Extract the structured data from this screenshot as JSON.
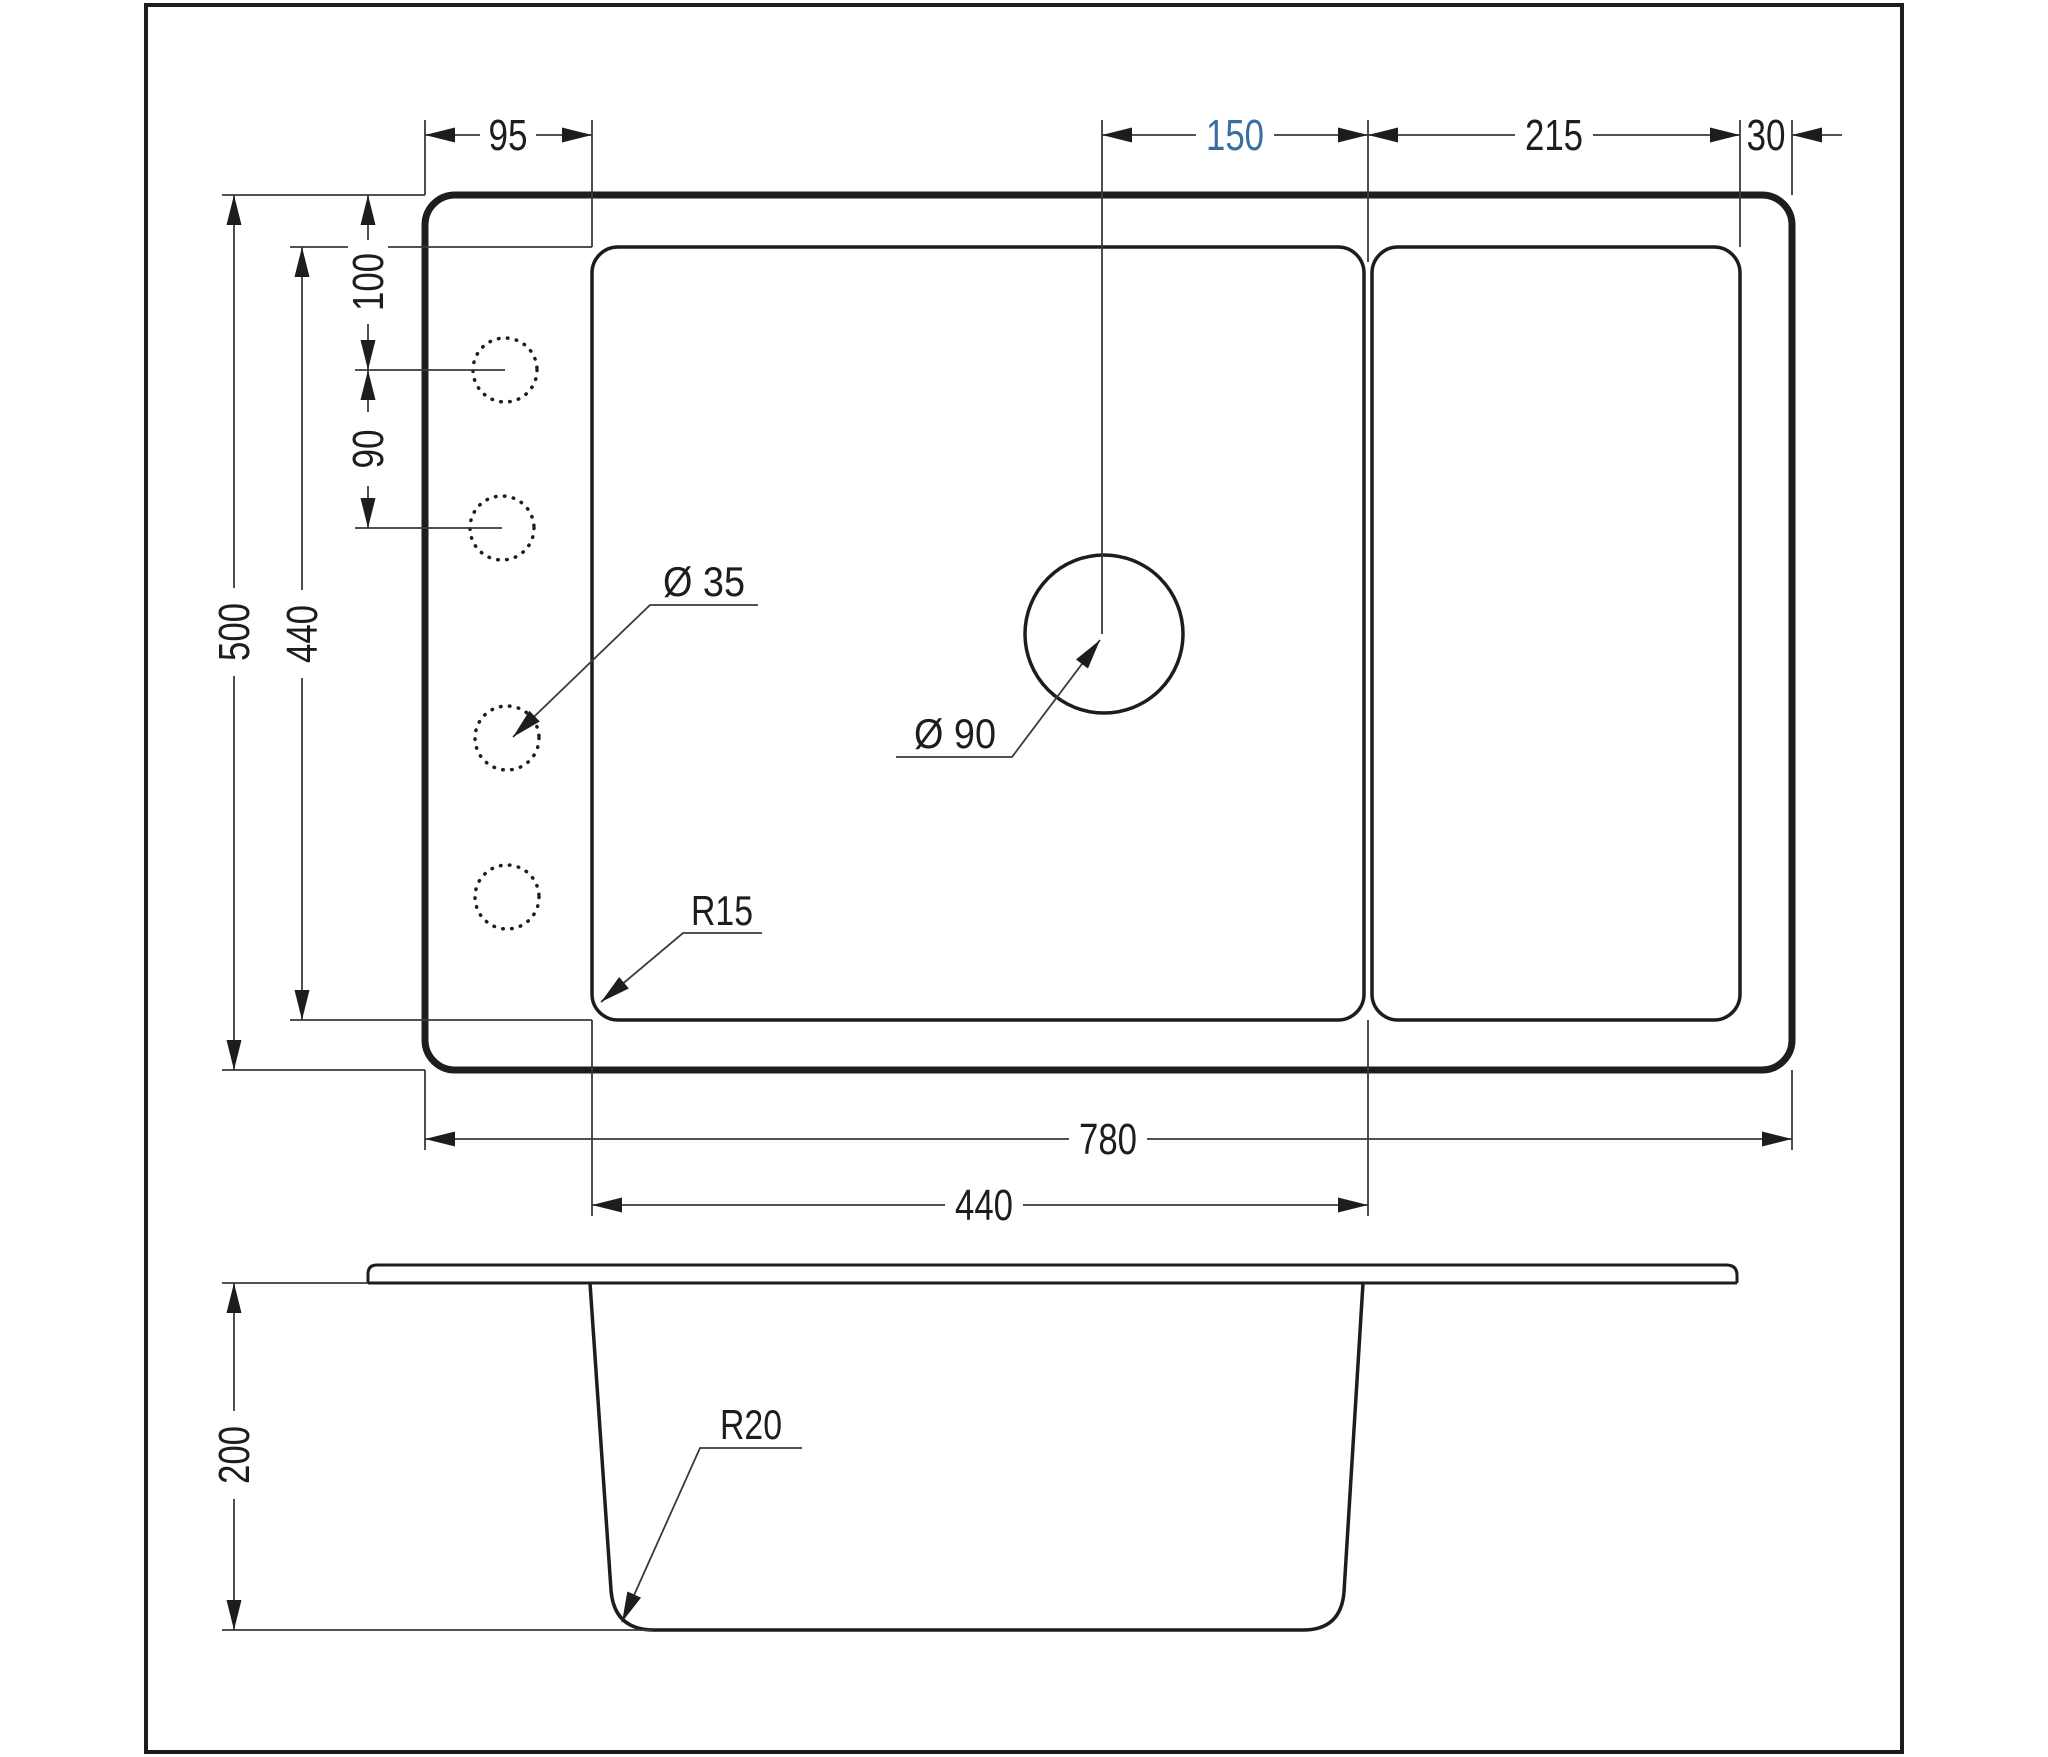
{
  "drawing": {
    "line_color": "#1d1d1b",
    "accent_color": "#376fa3",
    "background": "#ffffff"
  },
  "top_view": {
    "dims": {
      "left_offset": "95",
      "drain_offset": "150",
      "drain_to_edge": "215",
      "right_margin": "30",
      "hole_top_offset": "100",
      "hole_spacing": "90",
      "overall_depth": "500",
      "bowl_depth": "440",
      "overall_width": "780",
      "bowl_width": "440"
    },
    "labels": {
      "faucet_hole_diameter": "Ø 35",
      "drain_hole_diameter": "Ø 90",
      "bowl_corner_radius": "R15"
    }
  },
  "section_view": {
    "dims": {
      "depth": "200"
    },
    "labels": {
      "bottom_corner_radius": "R20"
    }
  }
}
